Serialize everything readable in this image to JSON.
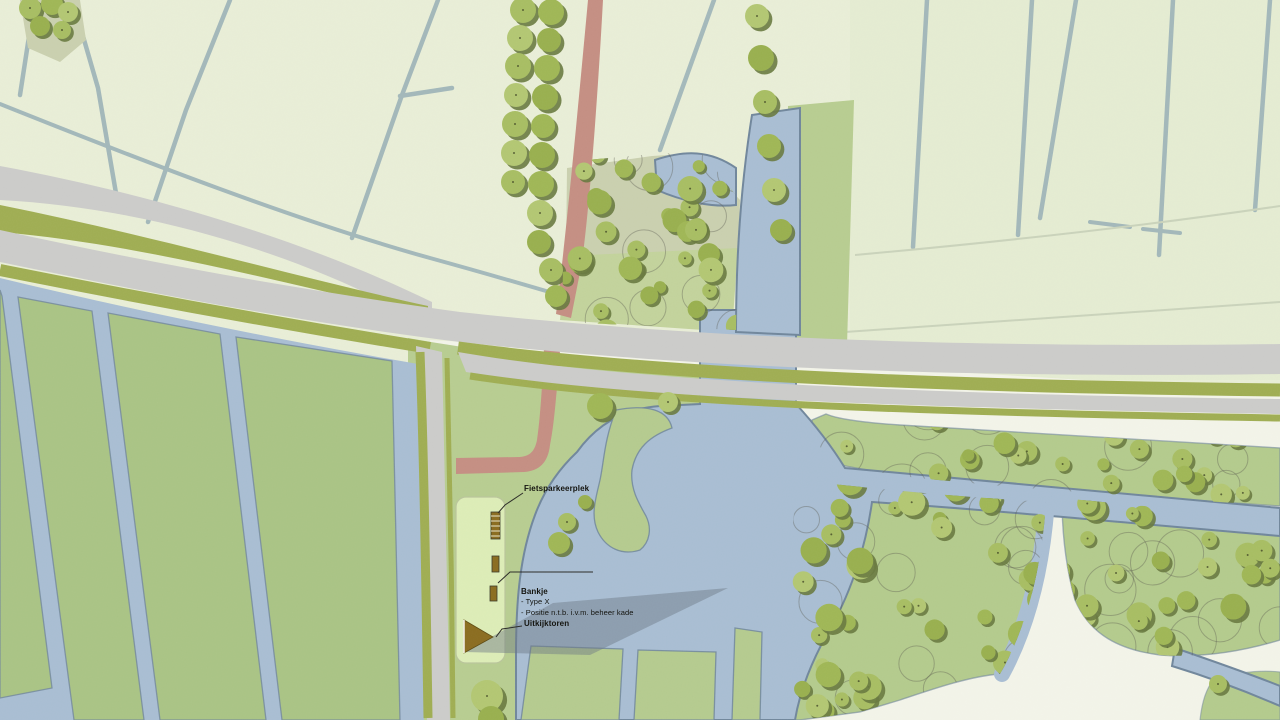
{
  "map_title": "Landscape site plan",
  "annotations": {
    "fietsparkeerplek": {
      "label": "Fietsparkeerplek"
    },
    "bankje": {
      "label": "Bankje",
      "lines": [
        "- Type X",
        "- Positie n.t.b. i.v.m. beheer kade"
      ]
    },
    "uitkijktoren": {
      "label": "Uitkijktoren"
    }
  },
  "features": {
    "water": "watergang / plas",
    "road_main": "weg",
    "path_red": "fiets-/wandelpad",
    "kade": "kade strook",
    "tower": "uitkijktoren",
    "benches": "bankjes",
    "bike_rack": "fietsparkeerplek"
  },
  "colors": {
    "paleField": "#e8edd6",
    "paleField2": "#e4ebd1",
    "ditch": "#9fb5b8",
    "faintLine": "#c9d2ba",
    "fieldGreen": "#a9c384",
    "parkGreen": "#b7cc90",
    "woodGreen": "#b3ca8c",
    "parcelGreen": "#b4ca8e",
    "groveTan": "#c9cfae",
    "groveGreen": "#c2d29b",
    "water": "#a8bdd2",
    "waterEdge": "#70869b",
    "roadGray": "#cbcbc9",
    "verge": "#9fad52",
    "pathRed": "#c48e82",
    "cream": "#f2f3e8",
    "kadeFill": "#dcecb6",
    "kadeEdge": "#b9c49a",
    "tree1": "#a7bd62",
    "tree2": "#9fb655",
    "tree3": "#b2c672",
    "tree4": "#98af4e",
    "treeShadow": "#68793f",
    "treeOutline": "#5a5a50",
    "furniture": "#8a6c1f",
    "shadow": "#6b7682",
    "leader": "#2a2a26",
    "text": "#14140f"
  }
}
